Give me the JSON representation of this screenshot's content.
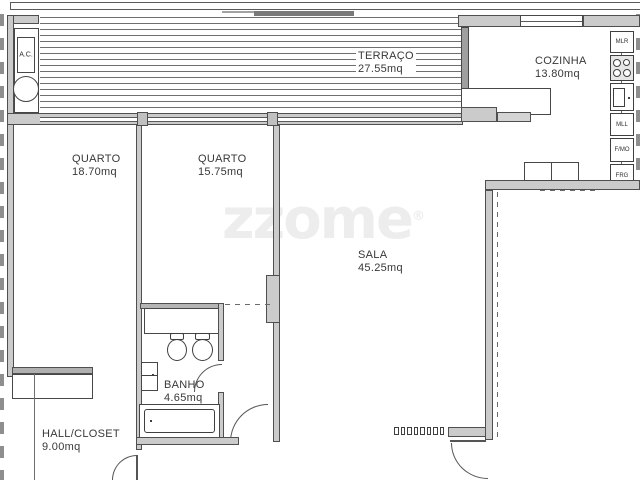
{
  "watermark": {
    "text": "zzome",
    "registered": "®"
  },
  "rooms": {
    "terraco": {
      "name": "TERRAÇO",
      "area": "27.55mq"
    },
    "cozinha": {
      "name": "COZINHA",
      "area": "13.80mq"
    },
    "quarto1": {
      "name": "QUARTO",
      "area": "18.70mq"
    },
    "quarto2": {
      "name": "QUARTO",
      "area": "15.75mq"
    },
    "sala": {
      "name": "SALA",
      "area": "45.25mq"
    },
    "banho": {
      "name": "BANHO",
      "area": "4.65mq"
    },
    "hall": {
      "name": "HALL/CLOSET",
      "area": "9.00mq"
    },
    "ac": {
      "name": "A.C."
    }
  },
  "appliances": {
    "mlr": "MLR",
    "mll": "MLL",
    "fmo": "F/MO",
    "frg": "FRG"
  },
  "colors": {
    "wall": "#cbcbcb",
    "wall_dark": "#9f9f9f",
    "outline": "#4f4f4f",
    "hatch": "#6f6f6f",
    "text": "#3c3c3c",
    "watermark": "#ededed"
  }
}
